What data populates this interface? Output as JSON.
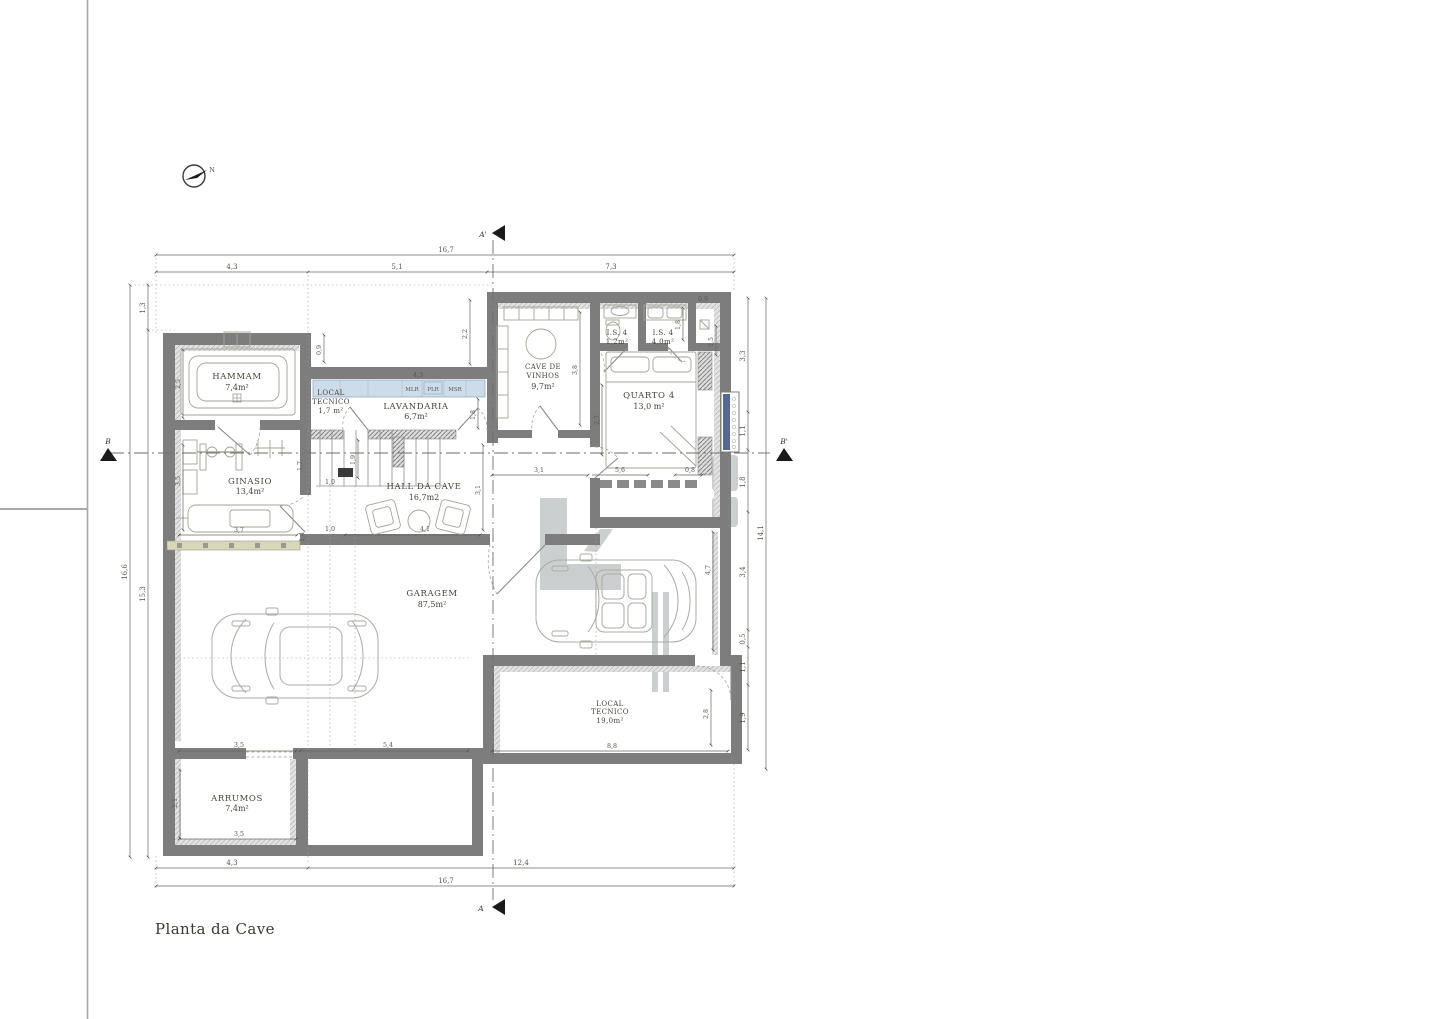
{
  "sheet": {
    "title": "Planta da Cave"
  },
  "compass": {
    "label": "N"
  },
  "section_markers": {
    "a_top": "A'",
    "a_bottom": "A",
    "b_left": "B",
    "b_right": "B'"
  },
  "rooms": {
    "hammam": {
      "name": "HAMMAM",
      "area": "7,4m²"
    },
    "local_tecnico_small": {
      "line1": "LOCAL",
      "line2": "TECNICO",
      "area": "1,7 m²"
    },
    "lavandaria": {
      "name": "LAVANDARIA",
      "area": "6,7m²"
    },
    "cave_vinhos": {
      "line1": "CAVE DE",
      "line2": "VINHOS",
      "area": "9,7m²"
    },
    "is4_a": {
      "name": "I.S. 4",
      "area": "1,2m²"
    },
    "is4_b": {
      "name": "I.S. 4",
      "area": "4,0m²"
    },
    "quarto4": {
      "name": "QUARTO 4",
      "area": "13,0 m²"
    },
    "ginasio": {
      "name": "GINASIO",
      "area": "13,4m²"
    },
    "hall": {
      "name": "HALL DA CAVE",
      "area": "16,7m2"
    },
    "garagem": {
      "name": "GARAGEM",
      "area": "87,5m²"
    },
    "local_tecnico_large": {
      "line1": "LOCAL",
      "line2": "TECNICO",
      "area": "19,0m²"
    },
    "arrumos": {
      "name": "ARRUMOS",
      "area": "7,4m²"
    }
  },
  "laundry": {
    "labels": [
      "MLR",
      "PLR",
      "MSR"
    ]
  },
  "dims": {
    "top": {
      "total": "16,7",
      "segments": [
        "4,3",
        "5,1",
        "7,3"
      ]
    },
    "bottom": {
      "total": "16,7",
      "segments": [
        "4,3",
        "12,4"
      ]
    },
    "left": {
      "outer": "16,6",
      "top": "1,3",
      "inner": "15,3"
    },
    "right": {
      "total": "14,1",
      "segments": [
        "3,3",
        "1,1",
        "1,8",
        "3,4",
        "0,5",
        "1,1",
        "1,9"
      ]
    },
    "internal": [
      "2,2",
      "0,9",
      "4,3",
      "1,8",
      "1,9",
      "1,7",
      "1,0",
      "1,4",
      "3,7",
      "1,0",
      "4,1",
      "3,1",
      "3,5",
      "2,5",
      "3,1",
      "5,6",
      "0,8",
      "2,7",
      "3,8",
      "0,9",
      "1,8",
      "1,5",
      "4,7",
      "5,4",
      "3,5",
      "3,5",
      "2,1",
      "8,8",
      "2,8"
    ]
  },
  "colors": {
    "wall": "#7d7d7d",
    "wall_lining": "#c3c3c3",
    "laundry_counter": "#cddcea",
    "window_strip": "#d8d7ba",
    "dimension_text": "#55554b",
    "label_text": "#45453a",
    "section_line": "#6e6e66",
    "watermark": "#9aa0a0",
    "grille_blue": "#56688e"
  }
}
